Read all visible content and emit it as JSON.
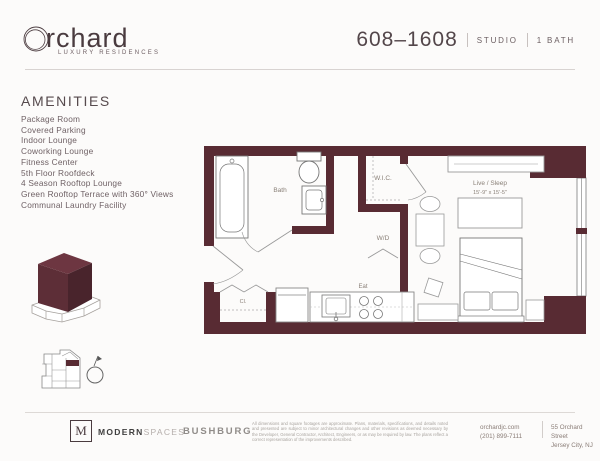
{
  "header": {
    "logo_text": "rchard",
    "logo_tagline": "LUXURY RESIDENCES",
    "unit_number": "608–1608",
    "unit_type": "STUDIO",
    "unit_bath": "1 BATH"
  },
  "amenities": {
    "title": "AMENITIES",
    "items": [
      "Package Room",
      "Covered Parking",
      "Indoor Lounge",
      "Coworking Lounge",
      "Fitness Center",
      "5th Floor Roofdeck",
      "4 Season Rooftop Lounge",
      "Green Rooftop Terrace with 360° Views",
      "Communal Laundry Facility"
    ]
  },
  "floorplan": {
    "labels": {
      "bath": "Bath",
      "wic": "W.I.C.",
      "wd": "W/D",
      "live_sleep": "Live / Sleep",
      "live_sleep_dims": "15'-9\" x 15'-5\"",
      "eat": "Eat",
      "closet": "Cl."
    }
  },
  "footer": {
    "broker_initial": "M",
    "broker_bold": "MODERN",
    "broker_light": "SPACES",
    "developer": "BUSHBURG",
    "disclaimer": "All dimensions and square footages are approximate. Plans, materials, specifications, and details noted and presented are subject to minor architectural changes and other revisions as deemed necessary by the Developer, General Contractor, Architect, Engineers, or as may be required by law. The plans reflect a correct representation of the improvements described.",
    "website": "orchardjc.com",
    "phone": "(201) 899-7111",
    "address1": "55 Orchard Street",
    "address2": "Jersey City, NJ"
  },
  "colors": {
    "accent": "#582b33",
    "text_dark": "#4a3b3f",
    "text_gray": "#6f6165"
  }
}
